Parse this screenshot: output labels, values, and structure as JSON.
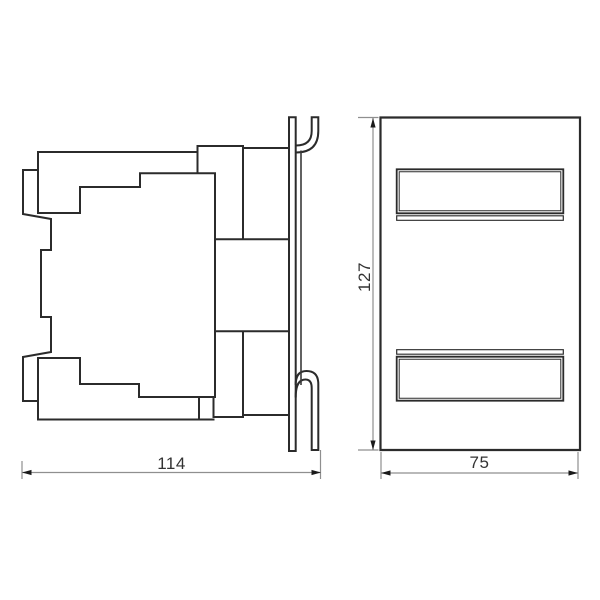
{
  "drawing": {
    "dimension_labels": {
      "side_width": "114",
      "front_height": "127",
      "front_width": "75"
    },
    "colors": {
      "background": "#ffffff",
      "outline": "#2b2b2b",
      "rail_line": "#3a3a3a",
      "dimension_line": "#8f8f8f",
      "arrow": "#1a1a1a",
      "text": "#333333"
    }
  }
}
